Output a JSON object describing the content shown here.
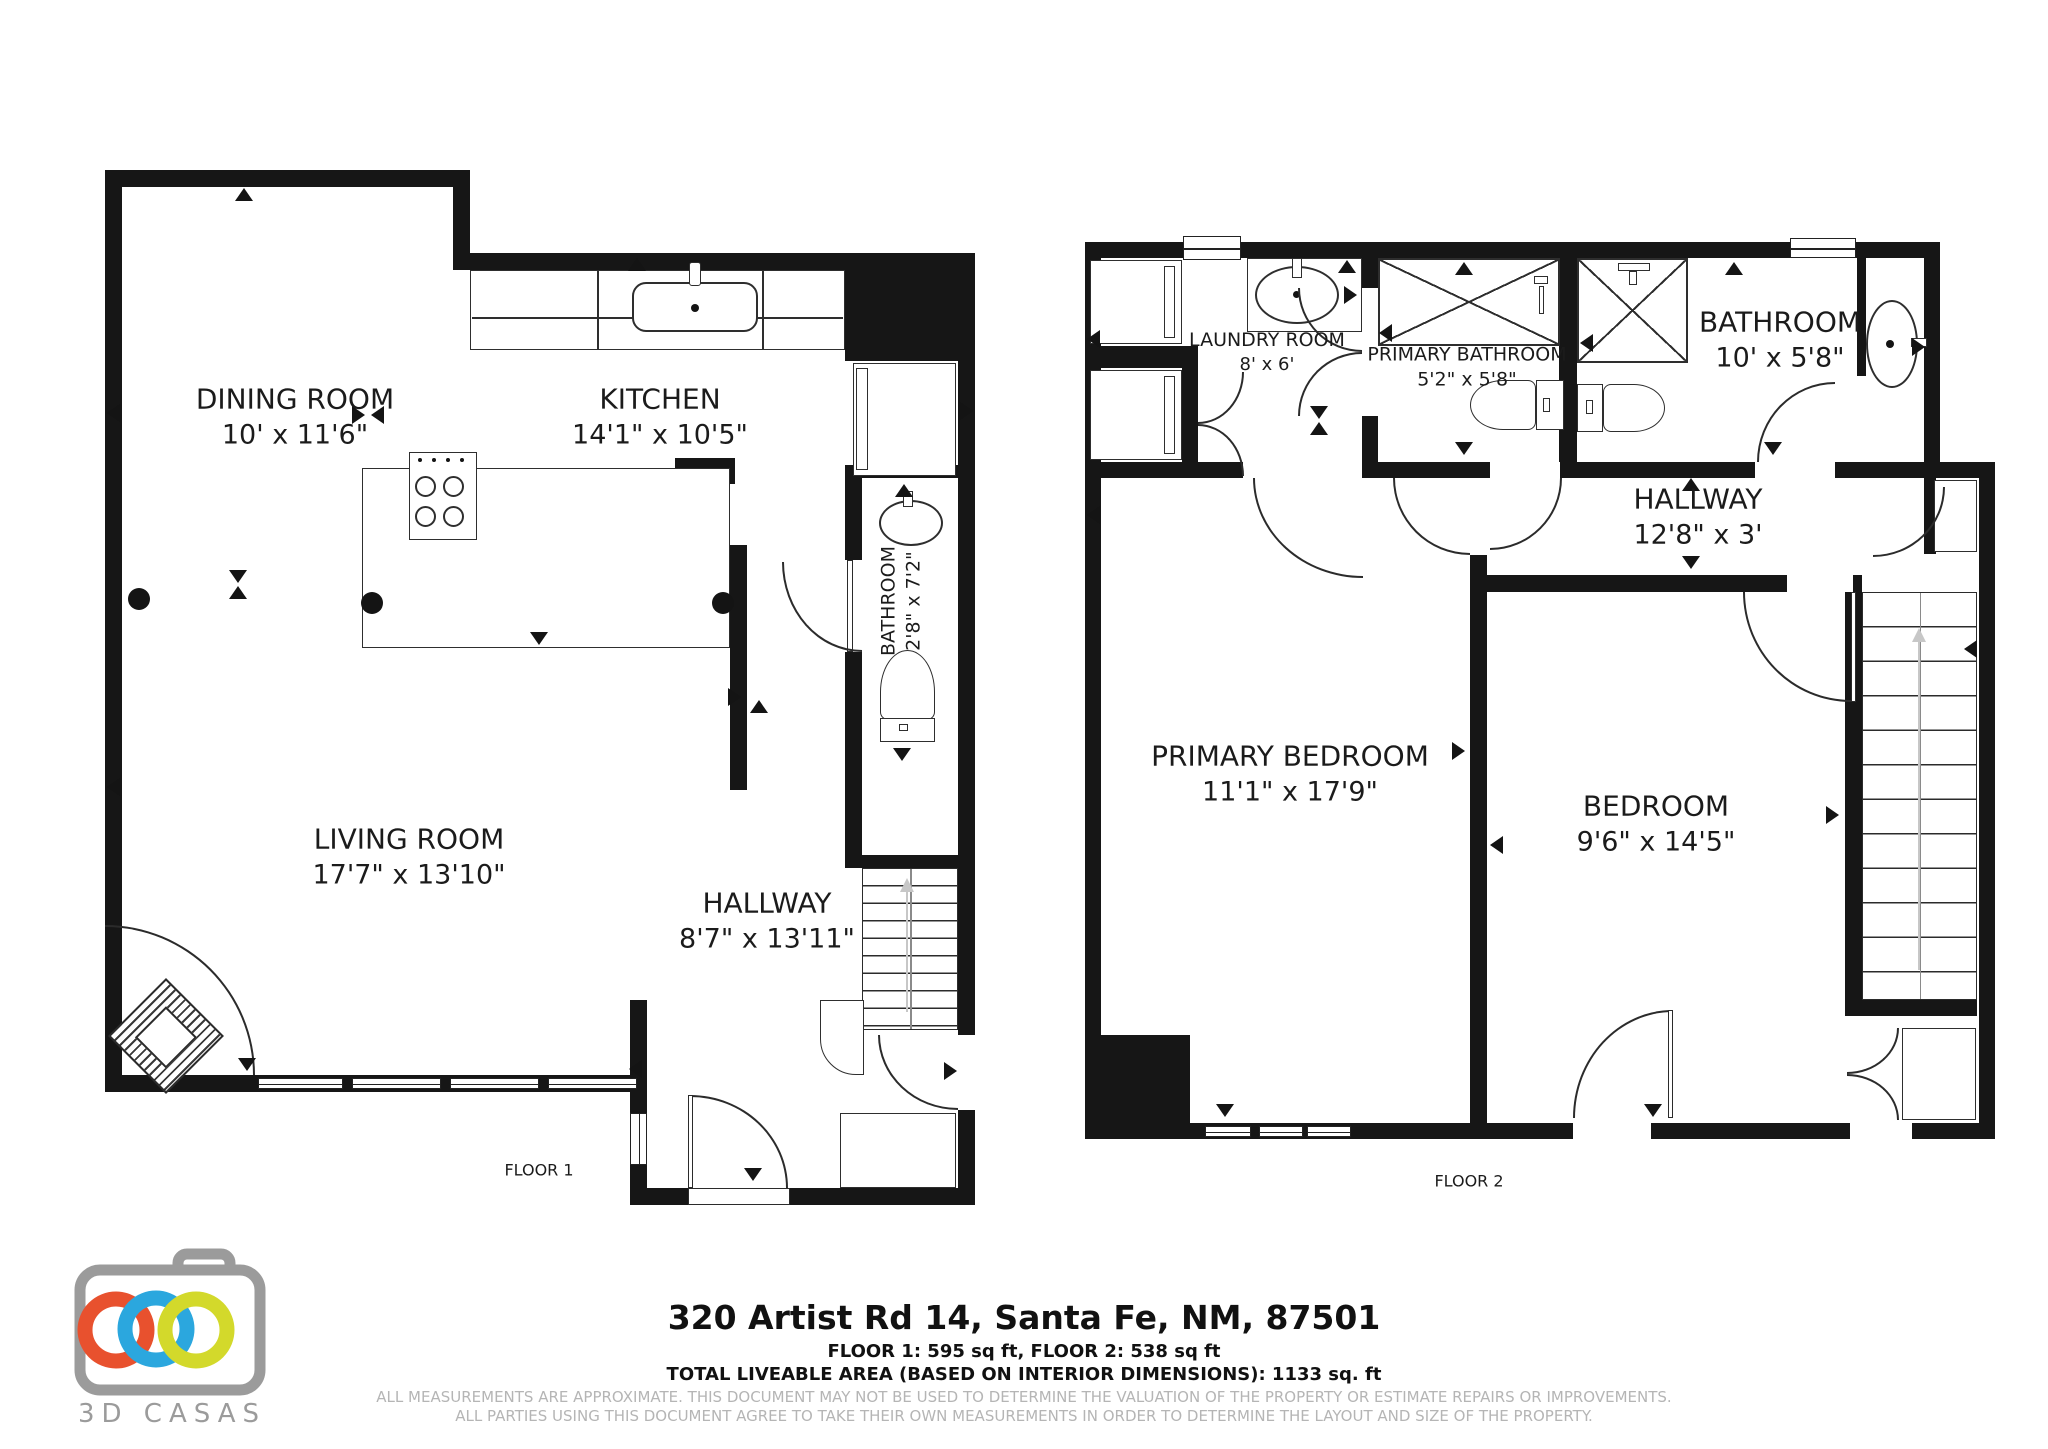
{
  "floor1": {
    "label": "FLOOR 1",
    "rooms": {
      "dining": {
        "name": "DINING ROOM",
        "dims": "10' x 11'6\""
      },
      "kitchen": {
        "name": "KITCHEN",
        "dims": "14'1\" x 10'5\""
      },
      "living": {
        "name": "LIVING ROOM",
        "dims": "17'7\" x 13'10\""
      },
      "hallway": {
        "name": "HALLWAY",
        "dims": "8'7\" x 13'11\""
      },
      "bathroom": {
        "name": "BATHROOM",
        "dims": "2'8\" x 7'2\""
      }
    }
  },
  "floor2": {
    "label": "FLOOR 2",
    "rooms": {
      "laundry": {
        "name": "LAUNDRY ROOM",
        "dims": "8' x 6'"
      },
      "primary_bathroom": {
        "name": "PRIMARY BATHROOM",
        "dims": "5'2\" x 5'8\""
      },
      "bathroom": {
        "name": "BATHROOM",
        "dims": "10' x 5'8\""
      },
      "hallway": {
        "name": "HALLWAY",
        "dims": "12'8\" x 3'"
      },
      "primary_bedroom": {
        "name": "PRIMARY BEDROOM",
        "dims": "11'1\" x 17'9\""
      },
      "bedroom": {
        "name": "BEDROOM",
        "dims": "9'6\" x 14'5\""
      }
    }
  },
  "footer": {
    "address": "320 Artist Rd 14, Santa Fe, NM, 87501",
    "floors_line": "FLOOR 1: 595 sq ft, FLOOR 2: 538 sq ft",
    "total_line": "TOTAL LIVEABLE AREA (BASED ON INTERIOR DIMENSIONS): 1133 sq. ft",
    "disclaimer_line1": "ALL MEASUREMENTS ARE APPROXIMATE. THIS DOCUMENT MAY NOT BE USED TO DETERMINE THE VALUATION OF THE PROPERTY OR ESTIMATE REPAIRS OR IMPROVEMENTS.",
    "disclaimer_line2": "ALL PARTIES USING THIS DOCUMENT AGREE TO TAKE THEIR OWN MEASUREMENTS IN ORDER TO DETERMINE THE LAYOUT AND SIZE OF THE PROPERTY."
  },
  "logo": {
    "brand": "3D CASAS",
    "colors": {
      "orange": "#E8512E",
      "blue": "#2BA7DE",
      "green": "#D3D92B",
      "gray": "#9B9B9B"
    }
  }
}
